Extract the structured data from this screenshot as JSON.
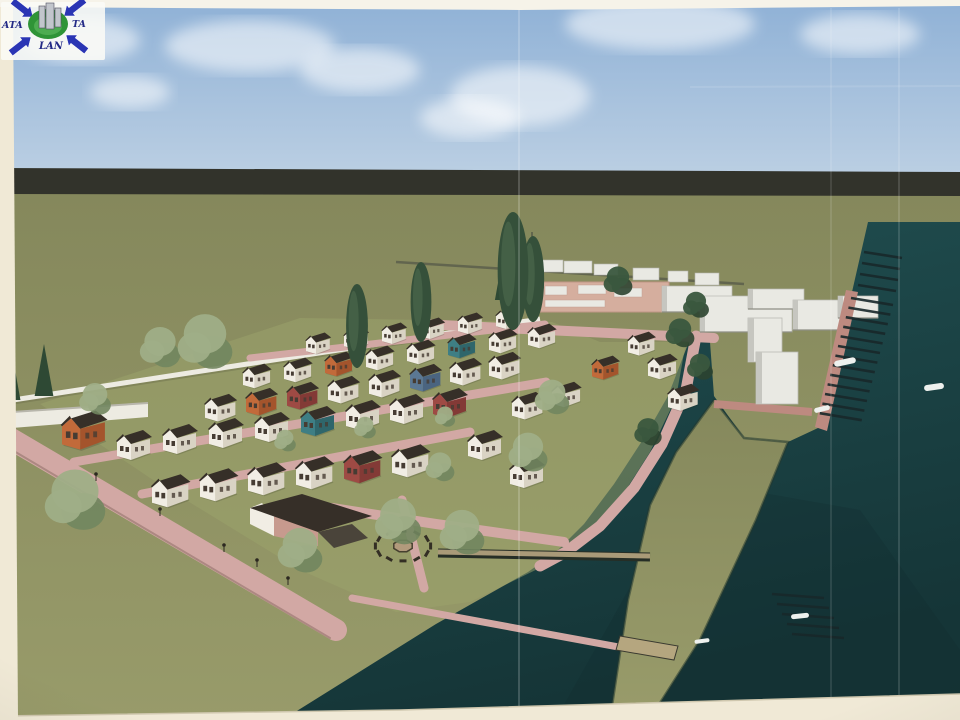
{
  "logo": {
    "left": "ATA",
    "right": "TA",
    "bottom": "LAN"
  },
  "palette": {
    "paper": "#f0e9d6",
    "paper_top": "#f6f3e9",
    "sky_top": "#8fb1d6",
    "sky_bottom": "#bbcfe3",
    "cloud": "#ffffff",
    "band": "#32332b",
    "ground_top": "#85885c",
    "ground_bottom": "#989b6a",
    "ground_light": "#9ba36b",
    "water_top": "#215052",
    "water_bottom": "#153537",
    "water_deep": "#112b2d",
    "road": "#d2a8a4",
    "road_edge": "#bd8a80",
    "wall": "#edebe2",
    "house_wall": "#f1ede4",
    "house_side": "#d9d3c4",
    "roof": "#362f28",
    "window": "#463c33",
    "accent_orange": "#c26a3a",
    "accent_orange_side": "#a4542c",
    "accent_red": "#9e4a44",
    "accent_red_side": "#833a36",
    "accent_teal": "#3e7e84",
    "accent_teal_side": "#2f666b",
    "accent_blue": "#5b7894",
    "accent_blue_side": "#4a6480",
    "tree_dark": "#35503a",
    "tree_sage": "#9fae87",
    "tree_sage_dark": "#71865f",
    "conifer": "#2e4934",
    "bldg": "#e9e9e3",
    "bldg_side": "#c6c6c0",
    "bldg_pink": "#d5ae9e",
    "pier": "#18282a",
    "boat": "#eef1ee",
    "plaza_tan": "#b29a7c",
    "dock_tan": "#b5a67f",
    "lamp": "#2c2820",
    "logo_blue": "#2a35b4",
    "logo_text": "#232a86",
    "logo_green": "#2f9437",
    "logo_bldg": "#c2c6cc"
  },
  "scene": {
    "clouds": [
      [
        250,
        46,
        170,
        26
      ],
      [
        520,
        96,
        140,
        30
      ],
      [
        660,
        24,
        190,
        26
      ],
      [
        860,
        34,
        120,
        20
      ],
      [
        130,
        92,
        80,
        16
      ],
      [
        470,
        118,
        100,
        20
      ],
      [
        80,
        40,
        120,
        22
      ],
      [
        360,
        70,
        120,
        22
      ]
    ],
    "houses": [
      [
        306,
        331,
        0.72
      ],
      [
        344,
        326,
        0.72
      ],
      [
        382,
        321,
        0.72
      ],
      [
        420,
        316,
        0.72
      ],
      [
        458,
        311,
        0.72
      ],
      [
        496,
        306,
        0.72
      ],
      [
        243,
        362,
        0.82
      ],
      [
        284,
        356,
        0.82
      ],
      [
        325,
        350,
        0.82,
        "orange"
      ],
      [
        366,
        344,
        0.82
      ],
      [
        407,
        338,
        0.82
      ],
      [
        448,
        332,
        0.82,
        "teal"
      ],
      [
        489,
        327,
        0.82
      ],
      [
        528,
        322,
        0.82
      ],
      [
        205,
        392,
        0.92
      ],
      [
        246,
        386,
        0.92,
        "orange"
      ],
      [
        287,
        380,
        0.92,
        "red"
      ],
      [
        328,
        374,
        0.92
      ],
      [
        369,
        368,
        0.92
      ],
      [
        410,
        362,
        0.92,
        "blue"
      ],
      [
        450,
        356,
        0.92
      ],
      [
        489,
        350,
        0.92
      ],
      [
        117,
        428,
        1.0
      ],
      [
        163,
        422,
        1.0
      ],
      [
        209,
        416,
        1.0
      ],
      [
        255,
        410,
        1.0
      ],
      [
        301,
        404,
        1.0,
        "teal"
      ],
      [
        346,
        398,
        1.0
      ],
      [
        390,
        392,
        1.0
      ],
      [
        433,
        386,
        1.0,
        "red"
      ],
      [
        152,
        472,
        1.1
      ],
      [
        200,
        466,
        1.1
      ],
      [
        248,
        460,
        1.1
      ],
      [
        296,
        454,
        1.1
      ],
      [
        344,
        448,
        1.1,
        "red"
      ],
      [
        392,
        442,
        1.1
      ],
      [
        62,
        408,
        1.3,
        "orange"
      ],
      [
        512,
        390,
        0.92
      ],
      [
        552,
        380,
        0.85
      ],
      [
        592,
        354,
        0.8,
        "orange"
      ],
      [
        468,
        428,
        1.0
      ],
      [
        510,
        456,
        1.0
      ],
      [
        628,
        330,
        0.8
      ],
      [
        648,
        352,
        0.85
      ],
      [
        668,
        382,
        0.9
      ]
    ],
    "trees": [
      {
        "t": "poplar",
        "x": 513,
        "y": 330,
        "h": 118
      },
      {
        "t": "poplar",
        "x": 533,
        "y": 322,
        "h": 86
      },
      {
        "t": "poplar",
        "x": 421,
        "y": 342,
        "h": 80
      },
      {
        "t": "poplar",
        "x": 357,
        "y": 368,
        "h": 84
      },
      {
        "t": "round",
        "x": 205,
        "y": 378,
        "h": 76
      },
      {
        "t": "round",
        "x": 160,
        "y": 374,
        "h": 56
      },
      {
        "t": "round",
        "x": 95,
        "y": 420,
        "h": 44
      },
      {
        "t": "round",
        "x": 75,
        "y": 540,
        "h": 84
      },
      {
        "t": "round",
        "x": 300,
        "y": 580,
        "h": 62
      },
      {
        "t": "round",
        "x": 398,
        "y": 552,
        "h": 64
      },
      {
        "t": "round",
        "x": 462,
        "y": 562,
        "h": 62
      },
      {
        "t": "round",
        "x": 528,
        "y": 478,
        "h": 54
      },
      {
        "t": "round",
        "x": 552,
        "y": 420,
        "h": 48
      },
      {
        "t": "round",
        "x": 440,
        "y": 486,
        "h": 40
      },
      {
        "t": "round",
        "x": 285,
        "y": 455,
        "h": 30
      },
      {
        "t": "round",
        "x": 365,
        "y": 442,
        "h": 30
      },
      {
        "t": "round",
        "x": 445,
        "y": 430,
        "h": 28
      },
      {
        "t": "round",
        "x": 680,
        "y": 352,
        "h": 40,
        "v": "dark"
      },
      {
        "t": "round",
        "x": 696,
        "y": 322,
        "h": 36,
        "v": "dark"
      },
      {
        "t": "round",
        "x": 700,
        "y": 384,
        "h": 36,
        "v": "dark"
      },
      {
        "t": "round",
        "x": 648,
        "y": 450,
        "h": 38,
        "v": "dark"
      },
      {
        "t": "round",
        "x": 618,
        "y": 300,
        "h": 40,
        "v": "dark"
      },
      {
        "t": "conifer",
        "x": 10,
        "y": 400,
        "h": 58
      },
      {
        "t": "conifer",
        "x": 44,
        "y": 396,
        "h": 52
      },
      {
        "t": "conifer",
        "x": 505,
        "y": 300,
        "h": 56
      },
      {
        "t": "conifer",
        "x": 518,
        "y": 306,
        "h": 44
      }
    ],
    "containers": [
      [
        533,
        260,
        30,
        12
      ],
      [
        564,
        261,
        28,
        12
      ],
      [
        594,
        264,
        24,
        11
      ],
      [
        633,
        268,
        26,
        12
      ],
      [
        668,
        271,
        20,
        11
      ],
      [
        695,
        273,
        24,
        12
      ]
    ],
    "flats": [
      [
        662,
        286,
        70,
        26
      ],
      [
        700,
        296,
        92,
        36
      ],
      [
        748,
        289,
        56,
        20
      ],
      [
        793,
        300,
        50,
        30
      ],
      [
        838,
        296,
        40,
        22
      ]
    ],
    "roof_units": [
      [
        545,
        286,
        22,
        9
      ],
      [
        578,
        285,
        28,
        9
      ],
      [
        614,
        288,
        28,
        9
      ],
      [
        545,
        300,
        60,
        7
      ]
    ],
    "piers": [
      {
        "n": 13,
        "x": 851,
        "y": 298,
        "dx": -2.6,
        "dy": 9.6,
        "len": 42,
        "drop": 7
      },
      {
        "n": 4,
        "x": 864,
        "y": 252,
        "dx": -2.0,
        "dy": 11.0,
        "len": 38,
        "drop": 6
      },
      {
        "n": 5,
        "x": 772,
        "y": 594,
        "dx": 5.0,
        "dy": 10.0,
        "len": 52,
        "drop": 4
      }
    ],
    "boats": [
      [
        845,
        362,
        22,
        6,
        -12
      ],
      [
        934,
        387,
        20,
        6,
        -8
      ],
      [
        822,
        409,
        16,
        5,
        -14
      ],
      [
        800,
        616,
        18,
        5,
        -6
      ],
      [
        702,
        641,
        15,
        4,
        -8
      ]
    ],
    "ring": {
      "cx": 403,
      "cy": 546,
      "r": 24,
      "benches": 12,
      "squash": 0.62
    },
    "lamps": [
      [
        96,
        481
      ],
      [
        160,
        516
      ],
      [
        224,
        552
      ],
      [
        257,
        567
      ],
      [
        288,
        585
      ]
    ],
    "creases": [
      [
        519,
        0.18
      ],
      [
        831,
        0.1
      ],
      [
        899,
        0.13
      ]
    ]
  }
}
